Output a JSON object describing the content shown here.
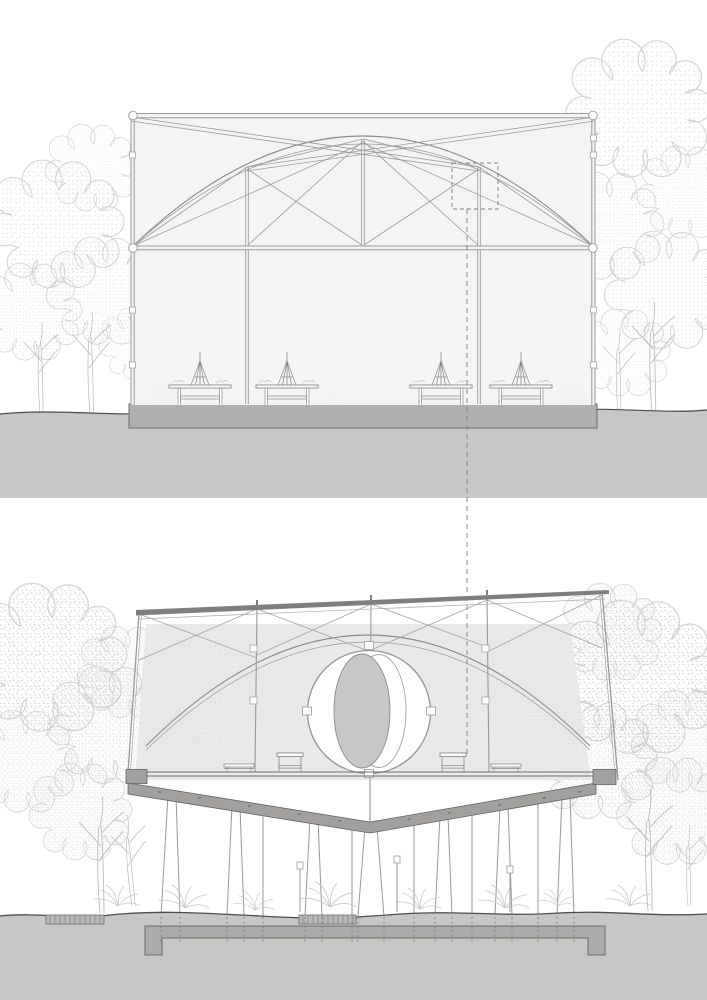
{
  "colors": {
    "paper": "#ffffff",
    "line": "#9a9a98",
    "line_mid": "#8a8a88",
    "line_dark": "#6c6c6a",
    "terrain_line": "#4e4e4c",
    "building_fill": "#f4f4f2",
    "wall_fill": "#e9e9e7",
    "ground_fill": "#c8c7c5",
    "upper_slab": "#b1b0ae",
    "floor_slab": "#a1a09e",
    "roof": "#7e7e7c",
    "foundation": "#acabab",
    "sphere_gray": "#c6c6c4",
    "tree_line": "#d2d2d0",
    "tree_trunk": "#bdbdbb",
    "stipple": "#d8d8d6",
    "stipple_dense": "#cacac8",
    "dashed_ref": "#7e7e7c"
  },
  "drawings": {
    "upper_elevation": {
      "tables": 4,
      "detail_callouts": 1
    },
    "lower_section": {
      "benches": 2,
      "stools": 2,
      "oculus": 1
    }
  }
}
